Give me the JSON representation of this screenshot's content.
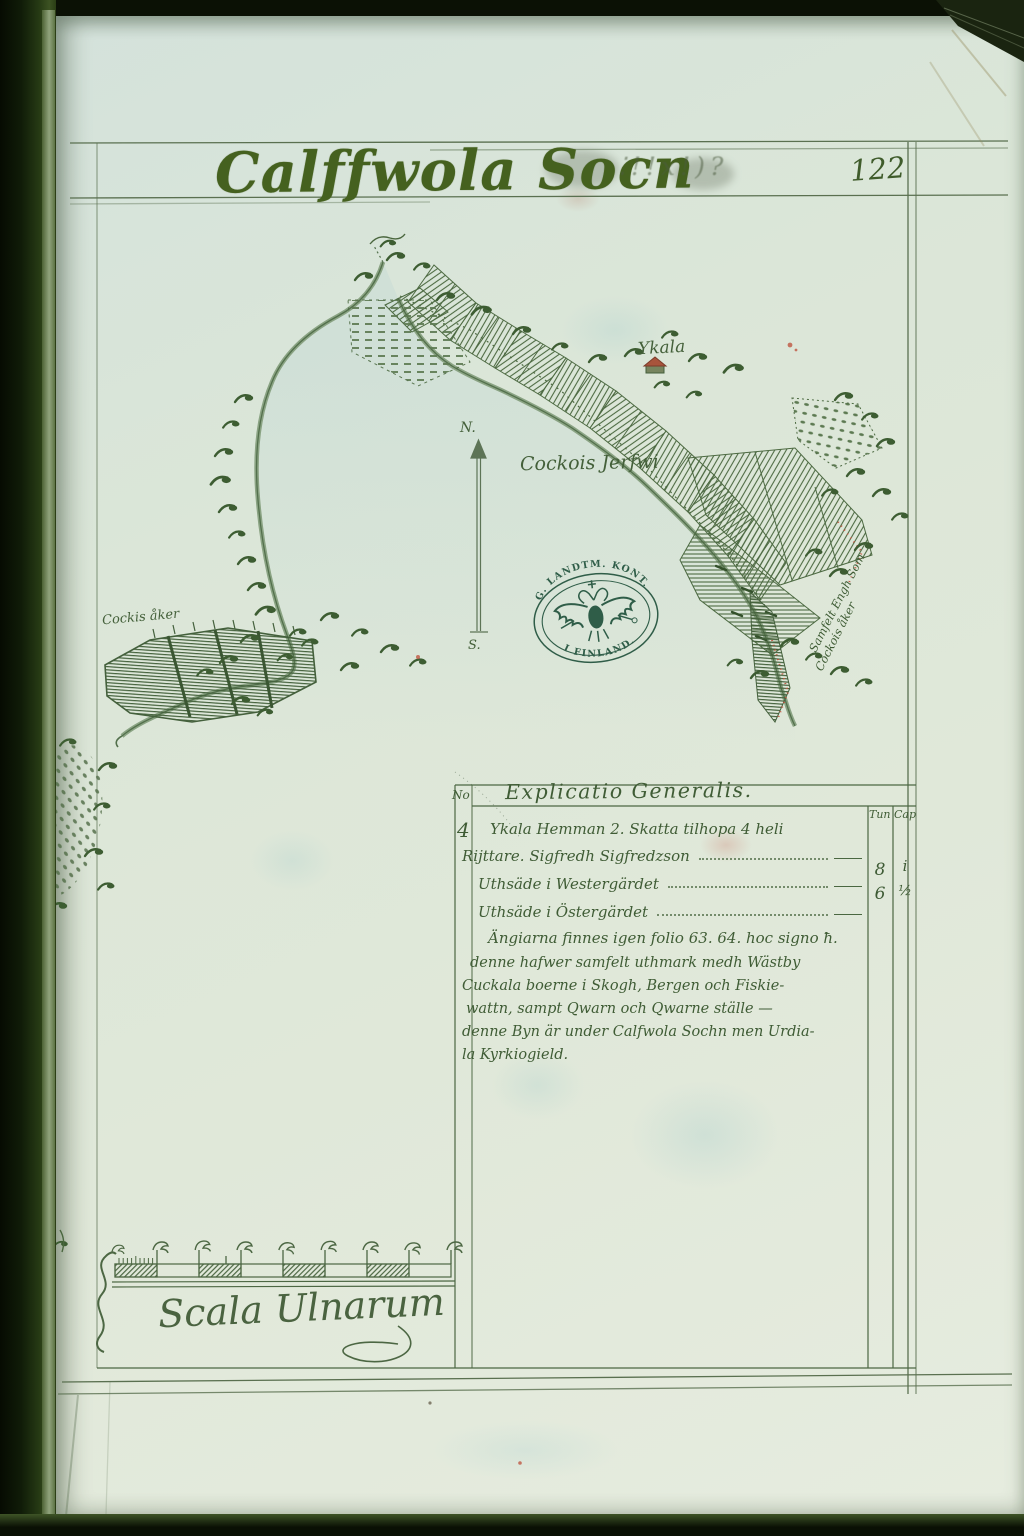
{
  "page": {
    "title": "Calffwola Socn",
    "title_marks": "⁚!!x!)?",
    "number": "122"
  },
  "map": {
    "village_label": "Ykala",
    "lake_label": "Cockois Jerfwi",
    "field_label": "Cockis åker",
    "edge_note_line1": "Samfelt Engh Som",
    "edge_note_line2": "Cockois åker",
    "compass_north": "N.",
    "compass_south": "S.",
    "stamp_top": "G. LANDTM. KONT.",
    "stamp_bottom": "I FINLAND."
  },
  "explicatio": {
    "title": "Explicatio Generalis.",
    "no_header": "No",
    "no_value": "4",
    "col_tun": "Tun",
    "col_cap": "Cap",
    "entry_lines": [
      "Ykala Hemman 2. Skatta tilhopa 4 heli",
      "Rijttare. Sigfredh Sigfredzson",
      "Uthsäde i Westergärdet",
      "Uthsäde i Östergärdet",
      "Ängiarna finnes igen folio 63. 64. hoc signo ħ."
    ],
    "values_tun": [
      "8",
      "6"
    ],
    "values_cap": [
      "i",
      "½"
    ],
    "note_lines": [
      "denne hafwer samfelt uthmark medh Wästby",
      "Cuckala boerne i Skogh, Bergen och Fiskie-",
      "wattn, sampt Qwarn och Qwarne ställe —",
      "denne Byn är under Calfwola Sochn men Urdia-",
      "la Kyrkiogield."
    ]
  },
  "scale": {
    "label": "Scala Ulnarum"
  },
  "colors": {
    "ink": "#41603a",
    "map_green": "#4e6b43",
    "stamp_green": "#2f5d48",
    "accent_red": "#bf5742",
    "paper": "#dde7d9"
  }
}
